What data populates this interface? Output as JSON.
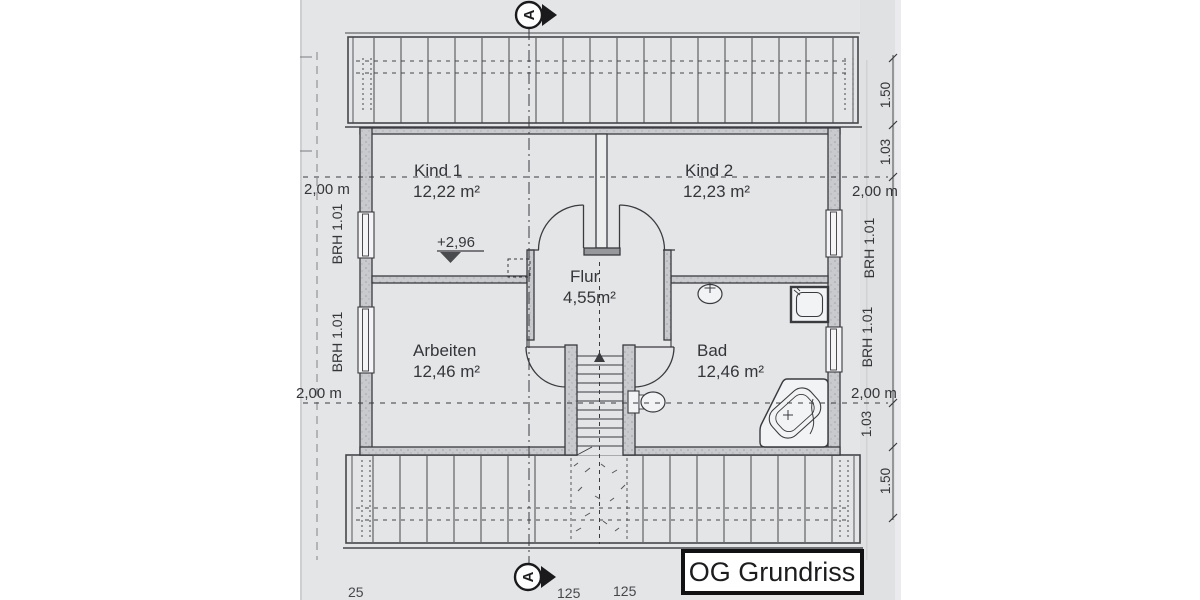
{
  "title_block": {
    "label": "OG Grundriss"
  },
  "section": {
    "marker": "A"
  },
  "rooms": {
    "kind1": {
      "name": "Kind 1",
      "area": "12,22 m²"
    },
    "kind2": {
      "name": "Kind 2",
      "area": "12,23 m²"
    },
    "flur": {
      "name": "Flur",
      "area": "4,55m²"
    },
    "arbeiten": {
      "name": "Arbeiten",
      "area": "12,46 m²"
    },
    "bad": {
      "name": "Bad",
      "area": "12,46 m²"
    }
  },
  "annotations": {
    "elevation": "+2,96",
    "left": {
      "level_top": "2,00 m",
      "brh_upper": "BRH 1.01",
      "brh_lower": "BRH 1.01",
      "level_bottom": "2,00 m"
    },
    "right": {
      "h_top1": "1.50",
      "h_top2": "1.03",
      "level_top": "2,00 m",
      "brh_upper": "BRH 1.01",
      "brh_lower": "BRH 1.01",
      "level_bottom": "2,00 m",
      "h_bot1": "1.03",
      "h_bot2": "1.50"
    },
    "bottom_numbers": {
      "n1": "25",
      "n2": "125",
      "n3": "125"
    }
  },
  "fixtures": {
    "stairs": "stairs-up",
    "wc": "toilet",
    "washbasin": "washbasin",
    "shower": "shower-tray",
    "bathtub": "corner-bathtub"
  },
  "colors": {
    "paper": "#e4e5e7",
    "ink": "#3a3b3f",
    "wall_fill": "#c8cacd"
  }
}
